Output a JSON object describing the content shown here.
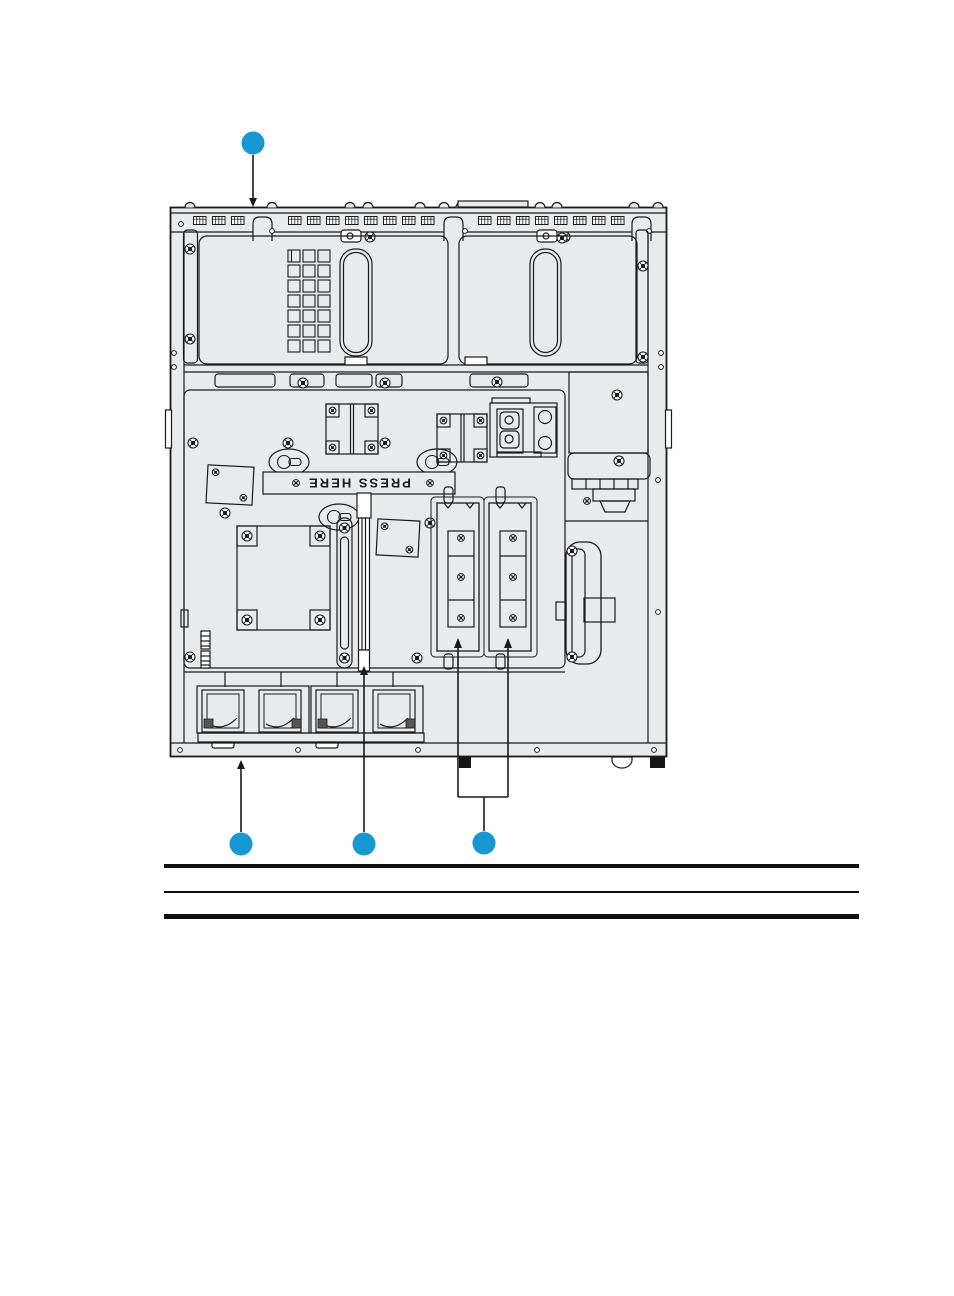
{
  "figure": {
    "press_here_label": "PRESS HERE",
    "callout_color": "#1798d2",
    "line_color": "#1a1a1a",
    "chassis_fill": "#e9eaec",
    "callouts": [
      {
        "name": "top",
        "shape": "circle",
        "label": ""
      },
      {
        "name": "bottom-left",
        "shape": "circle",
        "label": ""
      },
      {
        "name": "bottom-center",
        "shape": "circle",
        "label": ""
      },
      {
        "name": "bottom-right",
        "shape": "circle",
        "label": ""
      }
    ]
  },
  "table": {
    "visible_text": ""
  }
}
